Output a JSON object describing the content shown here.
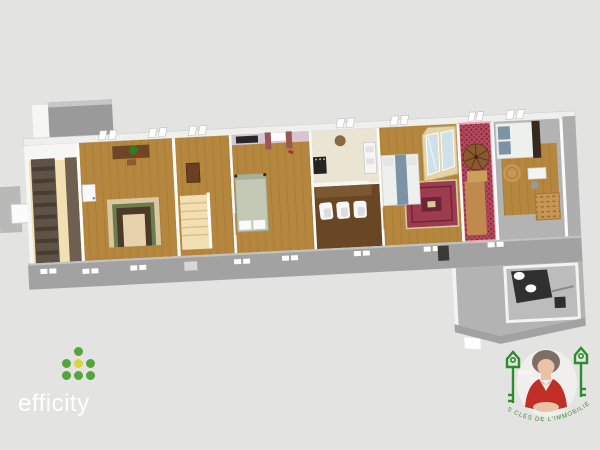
{
  "canvas": {
    "width": 600,
    "height": 450,
    "background": "#e3e3e2"
  },
  "branding": {
    "efficity_logo": {
      "text": "efficity",
      "text_white": "#ffffff",
      "dot_green": "#55a43c",
      "dot_yellow": "#ddd23f"
    },
    "agent_badge": {
      "watermark": "efficity",
      "curved_text": "LES CLÉS DE L'IMMOBILIER",
      "key_green": "#2e8b2e",
      "text_green": "#3f8a3a",
      "dress_red": "#bf2f28",
      "hair_gray": "#7d6f63",
      "skin": "#e9c3a6"
    }
  },
  "floorplan": {
    "view": "3d-isometric-single-level",
    "colors": {
      "bg": "#e3e3e2",
      "wall_white": "#f6f6f5",
      "wall_gray": "#a2a2a2",
      "floor_wood": "#b5873e",
      "floor_wood_light": "#c08a4e",
      "floor_dining": "#6a4724",
      "floor_kitchen": "#eae4d3",
      "floor_gray": "#b3b3b3",
      "stair_beige": "#f2dfb2",
      "stair_dark_wall": "#5f5347",
      "stair_dark_step": "#473d33",
      "stair_dark_wall2": "#6e5f50",
      "pink_wall": "#d9c4d1",
      "curtain_red": "#9a5652",
      "tv_dark": "#26262c",
      "rug_red": "#9c3c4e",
      "rug_border": "#d9c8a2",
      "carpet_red": "#b24a5c",
      "carpet_red_dark": "#7e2638",
      "highlight_pink": "#f0a3b6",
      "wardrobe_cream": "#e5d3a5",
      "mirror_blue": "#cfe0e8",
      "duvet_white": "#eef0ee",
      "pillow_blue": "#7b93a4",
      "headboard_dark": "#38291d",
      "wicker": "#c79655",
      "vanity_dark": "#303030",
      "desk_brown": "#6e4526",
      "plant_green": "#2f7d22",
      "sideboard": "#7c5832",
      "chair_white": "#f7f7f7",
      "bed_sage": "#c3c9b4",
      "landing_tan": "#caa05c"
    },
    "rooms": [
      {
        "id": "entry-staircase",
        "label": "staircase entry",
        "floor": "stair_beige",
        "features": [
          "dark wood staircase",
          "dark wood walls"
        ]
      },
      {
        "id": "office",
        "label": "office / study",
        "floor": "floor_wood",
        "features": [
          "desk with green plant",
          "layered area rug",
          "wall cabinet"
        ]
      },
      {
        "id": "stair-hall",
        "label": "stair hall",
        "floor": "floor_wood",
        "features": [
          "beige staircase",
          "tall brown cabinet"
        ]
      },
      {
        "id": "bedroom-pink",
        "label": "bedroom with pink wall",
        "floor": "floor_wood",
        "features": [
          "wall tv",
          "red curtains",
          "double bed with sage cover"
        ]
      },
      {
        "id": "kitchen-dining",
        "label": "kitchen and dining room",
        "floor": "floor_kitchen",
        "features": [
          "dark range",
          "white counter",
          "round table",
          "three white chairs",
          "sideboard"
        ]
      },
      {
        "id": "bedroom-rug",
        "label": "bedroom with oriental rug",
        "floor": "floor_wood",
        "features": [
          "double bed",
          "red oriental rug",
          "mirrored cream wardrobe"
        ]
      },
      {
        "id": "spiral-stair",
        "label": "spiral staircase room (pink highlighted)",
        "floor": "carpet_red",
        "features": [
          "wooden spiral staircase",
          "red patterned carpet",
          "pink outline"
        ]
      },
      {
        "id": "bedroom-right",
        "label": "bedroom",
        "floor": "floor_gray",
        "features": [
          "double bed with blue pillows",
          "round wicker rug",
          "white desk",
          "wicker chest"
        ]
      },
      {
        "id": "bathroom",
        "label": "bathroom annex",
        "floor": "floor_gray",
        "features": [
          "dark double vanity",
          "two white basins",
          "dark stool",
          "towel rail"
        ]
      }
    ]
  }
}
